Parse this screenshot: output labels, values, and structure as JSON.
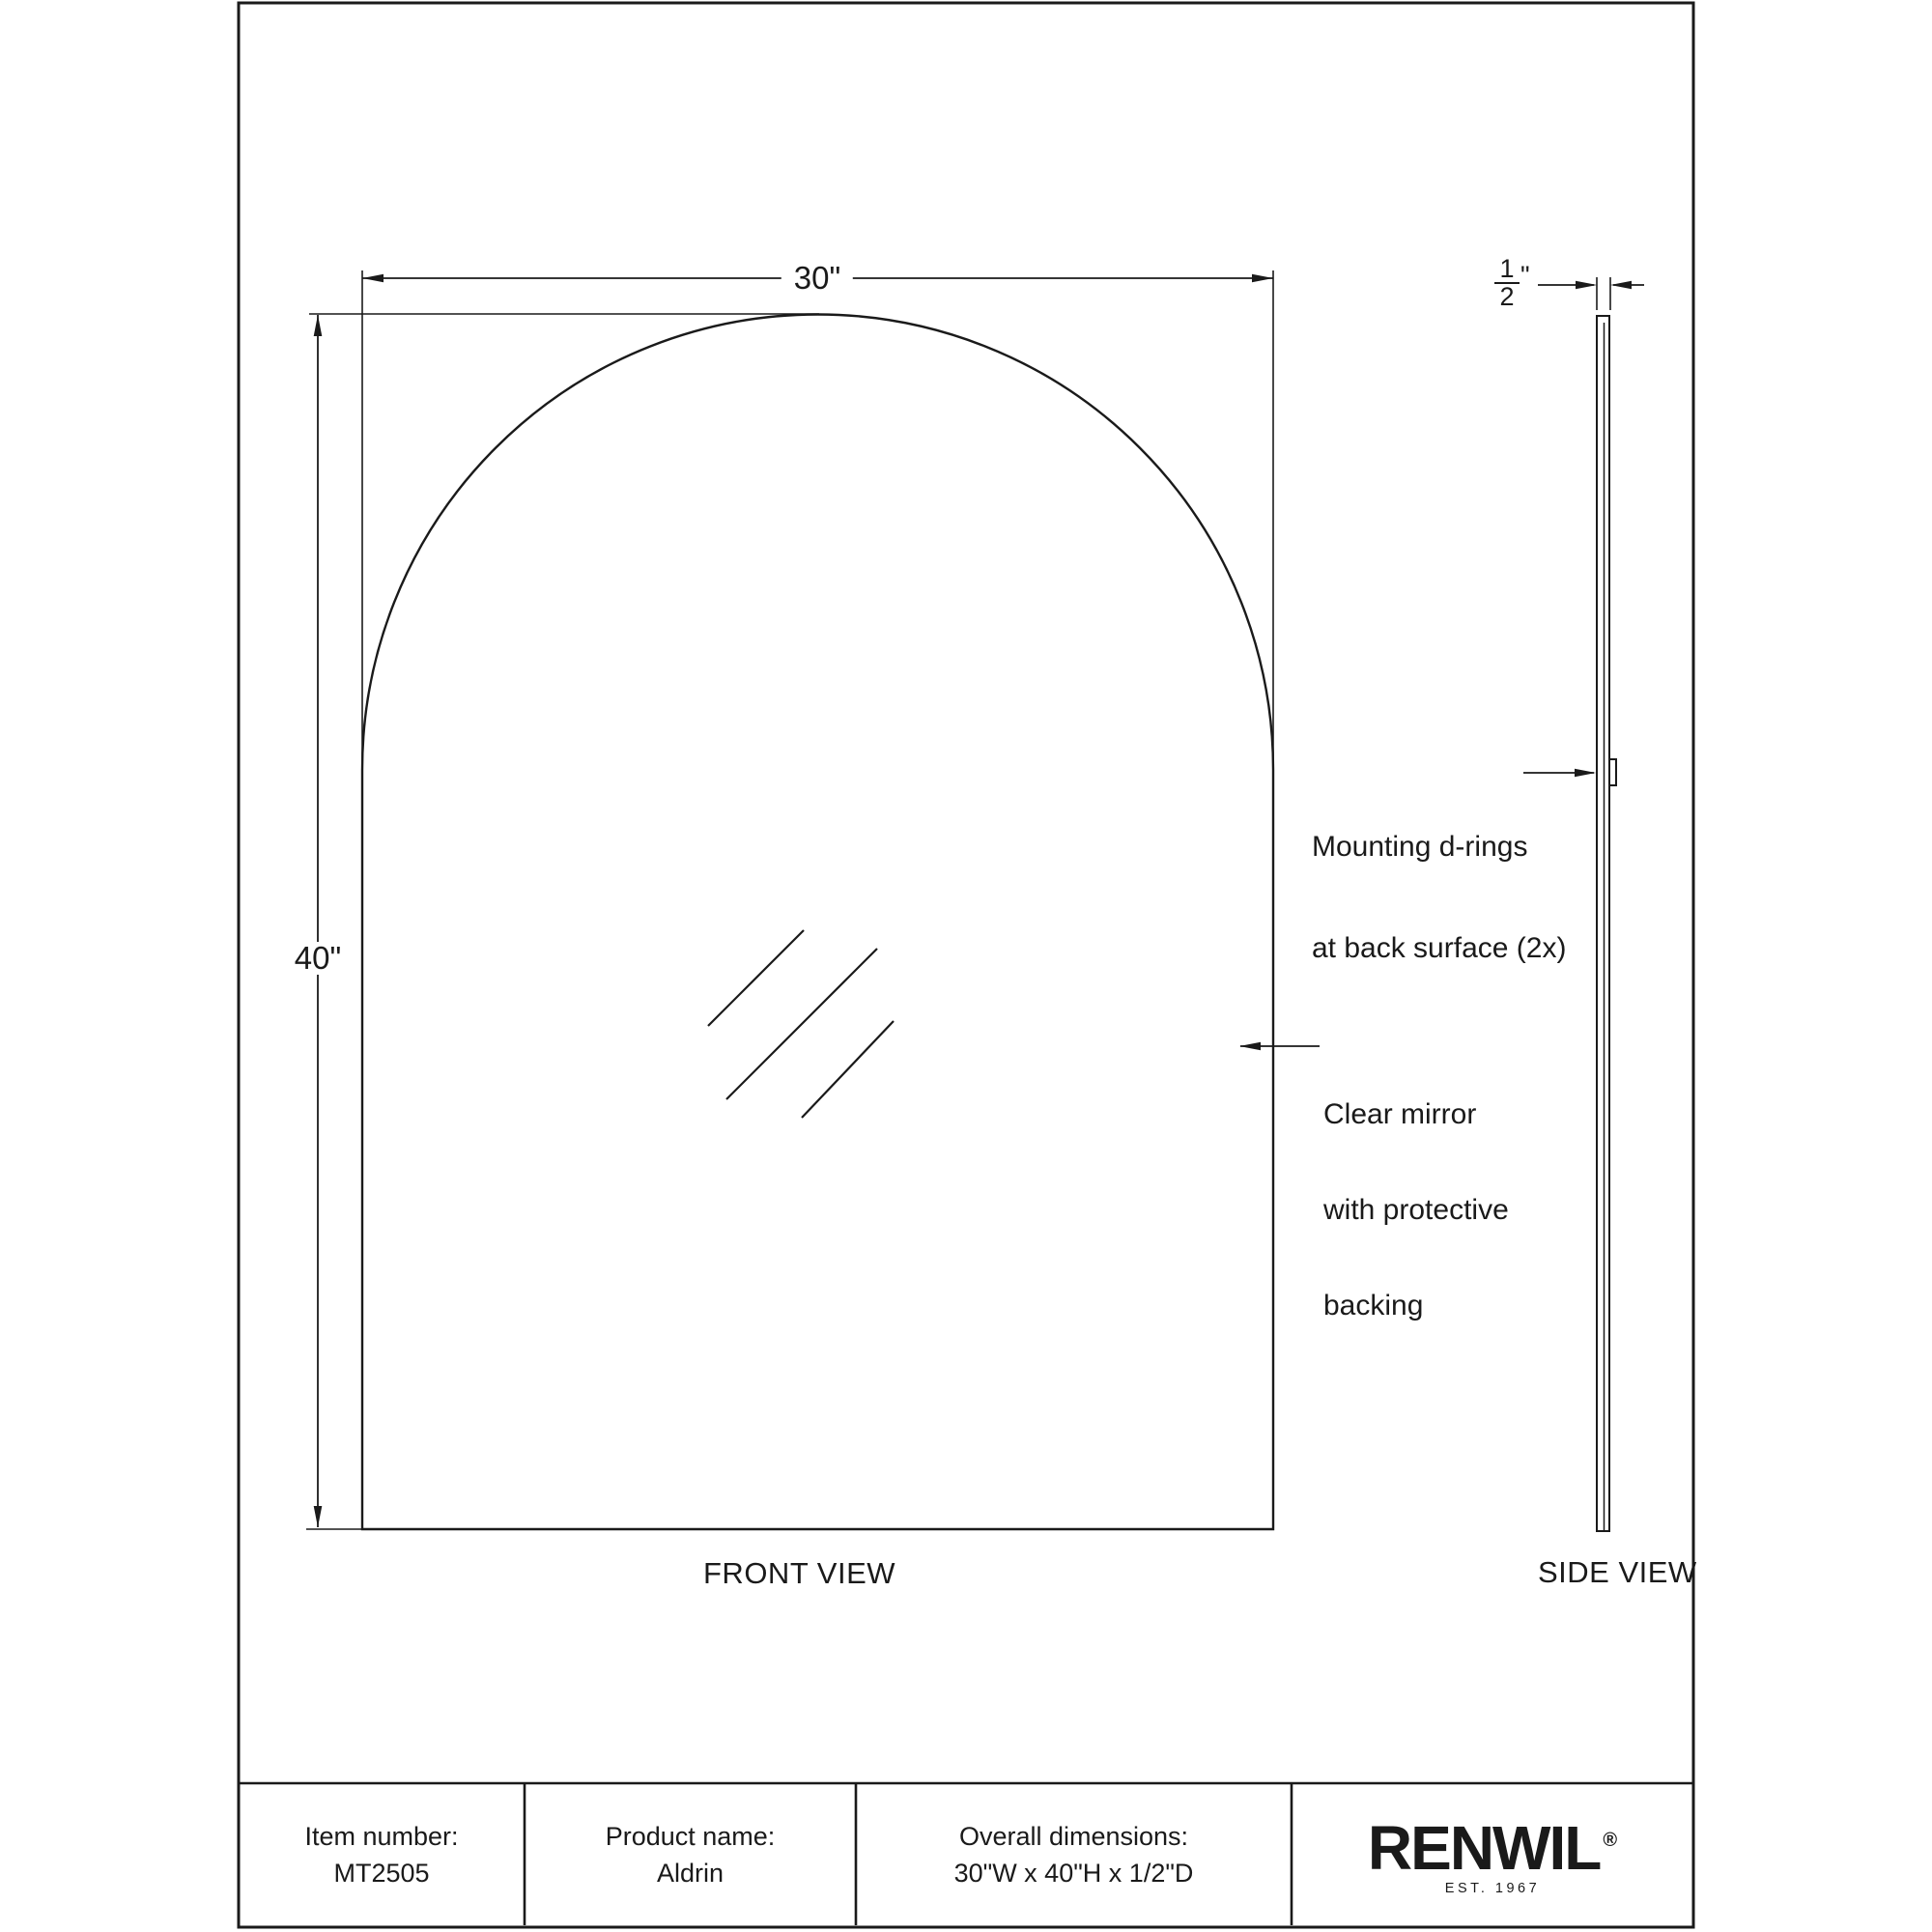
{
  "drawing": {
    "front_view_label": "FRONT VIEW",
    "side_view_label": "SIDE VIEW",
    "width_dim": "30\"",
    "height_dim": "40\"",
    "depth_dim": {
      "numerator": "1",
      "denominator": "2",
      "unit": "\""
    },
    "annotations": {
      "mounting": [
        "Mounting d-rings",
        "at back surface (2x)"
      ],
      "mirror": [
        "Clear mirror",
        "with protective",
        "backing"
      ]
    }
  },
  "title_block": {
    "item_number_label": "Item number:",
    "item_number_value": "MT2505",
    "product_name_label": "Product name:",
    "product_name_value": "Aldrin",
    "dimensions_label": "Overall dimensions:",
    "dimensions_value": "30\"W x 40\"H x 1/2\"D",
    "brand": {
      "name": "RENWIL",
      "registered": "®",
      "est": "EST. 1967"
    }
  },
  "colors": {
    "line": "#1a1a1a",
    "text": "#1a1a1a",
    "background": "#ffffff"
  }
}
